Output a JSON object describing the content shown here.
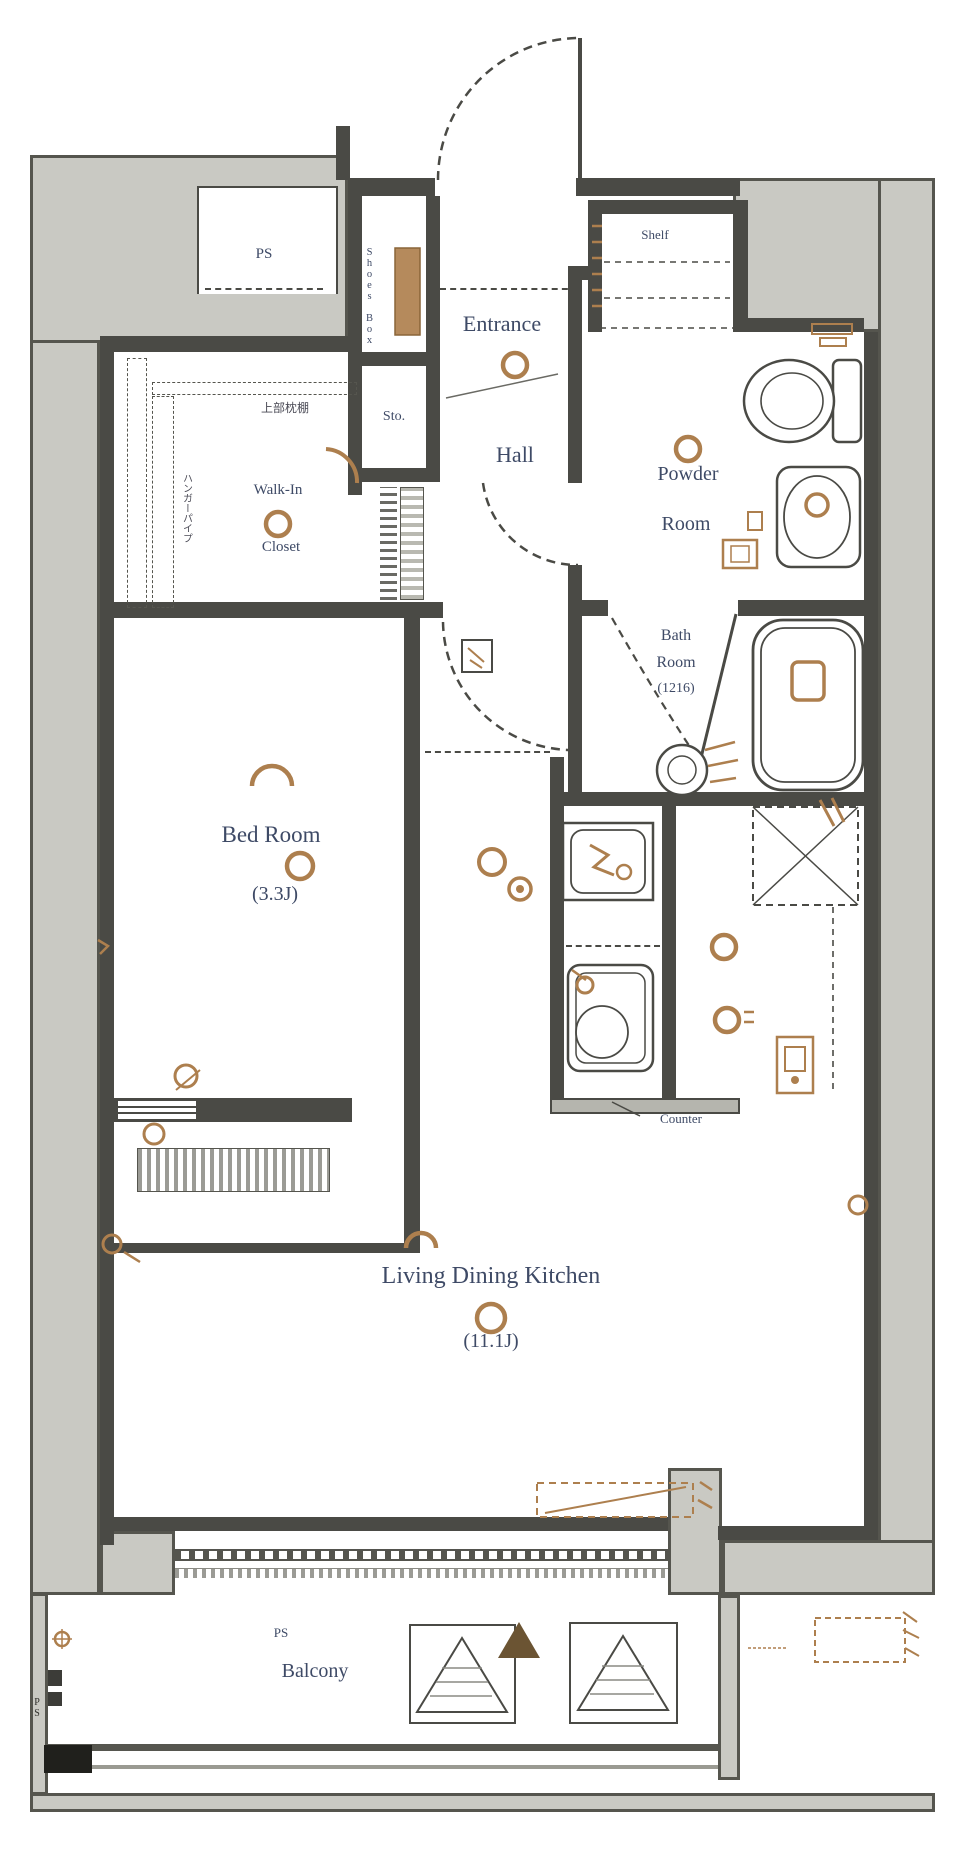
{
  "plan": {
    "type": "apartment-floor-plan",
    "labels": {
      "ps_top": "PS",
      "shelf": "Shelf",
      "entrance": "Entrance",
      "hall": "Hall",
      "shoes_box": "Shoes Box",
      "storage": "Sto.",
      "wic_line1": "Walk-In",
      "wic_line2": "Closet",
      "wic_note_top": "上部枕棚",
      "wic_note_side": "ハンガーパイプ",
      "powder_line1": "Powder",
      "powder_line2": "Room",
      "bath_line1": "Bath",
      "bath_line2": "Room",
      "bath_size": "(1216)",
      "bedroom": "Bed Room",
      "bedroom_size": "(3.3J)",
      "ldk": "Living Dining Kitchen",
      "ldk_size": "(11.1J)",
      "counter": "Counter",
      "balcony": "Balcony",
      "balcony_ps": "PS",
      "ps_bottom": "PS"
    },
    "colors": {
      "wall_gray": "#c9c9c3",
      "line_dark": "#4a4a45",
      "accent_brown": "#ad7f4e",
      "text_navy": "#3e4a66"
    },
    "icons": [
      "entrance-door-icon",
      "powder-door-icon",
      "ldk-door-icon",
      "bath-door-icon",
      "toilet-icon",
      "washbasin-icon",
      "bathtub-icon",
      "wash-bowl-icon",
      "washing-machine-pan-icon",
      "kitchen-sink-icon",
      "refrigerator-space-icon",
      "ceiling-light-icon",
      "evacuation-hatch-icon",
      "north-arrow-icon",
      "air-conditioner-icon",
      "drain-icon",
      "outlet-icon",
      "shoe-shelf-icon"
    ]
  }
}
